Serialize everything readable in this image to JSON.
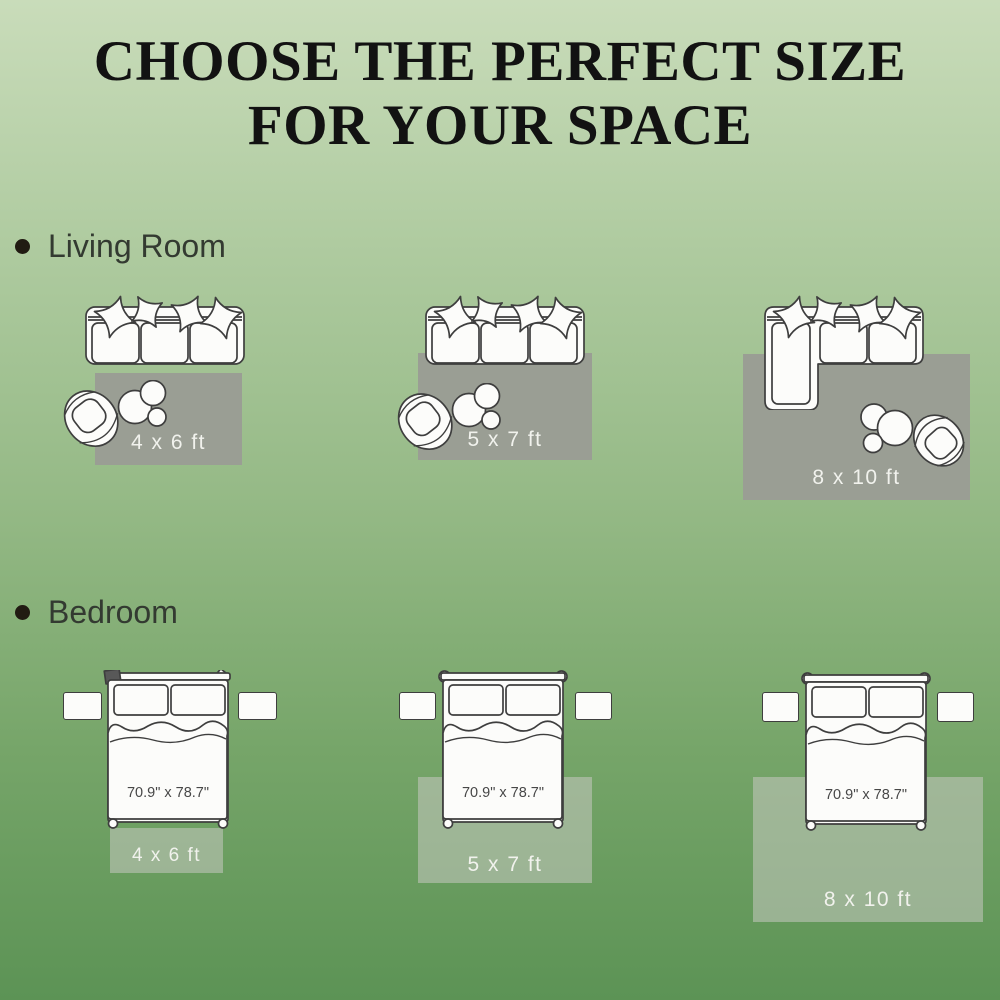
{
  "title": {
    "line1": "CHOOSE THE PERFECT SIZE",
    "line2": "FOR YOUR SPACE"
  },
  "sections": [
    {
      "label": "Living Room",
      "layouts": [
        {
          "rug_size": "4 x 6 ft"
        },
        {
          "rug_size": "5 x 7 ft"
        },
        {
          "rug_size": "8 x 10 ft"
        }
      ]
    },
    {
      "label": "Bedroom",
      "layouts": [
        {
          "rug_size": "4 x 6 ft",
          "bed_dimensions": "70.9\" x 78.7\""
        },
        {
          "rug_size": "5 x 7 ft",
          "bed_dimensions": "70.9\" x 78.7\""
        },
        {
          "rug_size": "8 x 10 ft",
          "bed_dimensions": "70.9\" x 78.7\""
        }
      ]
    }
  ],
  "colors": {
    "background_top": "#c9dcba",
    "background_bottom": "#5c9355",
    "rug_living": "#9a9e94",
    "rug_bedroom_overlay": "#c6c9c1",
    "title_text": "#121212",
    "section_text": "#333a31",
    "rug_label_text": "#f1f2ed",
    "bed_dimension_text": "#474747",
    "illustration_stroke": "#3e3e3e",
    "illustration_fill": "#fcfcfa"
  }
}
